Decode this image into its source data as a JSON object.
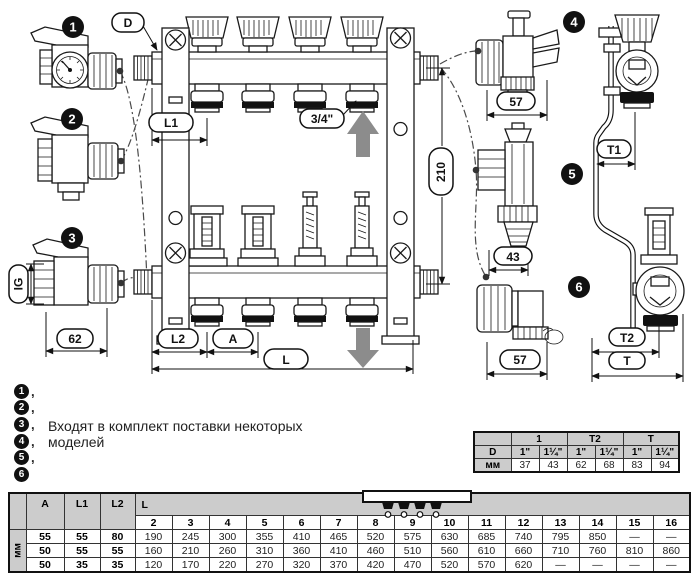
{
  "drawing": {
    "callout_numbers": {
      "n1": "1",
      "n2": "2",
      "n3": "3",
      "n4": "4",
      "n5": "5",
      "n6": "6"
    },
    "labels": {
      "d": "D",
      "l1": "L1",
      "three_quarter": "3/4\"",
      "h210": "210",
      "l2": "L2",
      "a": "A",
      "l": "L",
      "w57_top": "57",
      "w43": "43",
      "w57_bottom": "57",
      "t1": "T1",
      "t2": "T2",
      "t": "T",
      "ig": "IG",
      "w62": "62"
    }
  },
  "legend": {
    "items": [
      {
        "num": "1",
        "suffix": ","
      },
      {
        "num": "2",
        "suffix": ","
      },
      {
        "num": "3",
        "suffix": ","
      },
      {
        "num": "4",
        "suffix": ","
      },
      {
        "num": "5",
        "suffix": ","
      },
      {
        "num": "6",
        "suffix": ""
      }
    ],
    "line1": "Входят в комплект поставки некоторых",
    "line2": "моделей"
  },
  "right_table": {
    "group_headers": [
      "1",
      "T2",
      "T"
    ],
    "d_row": {
      "label": "D",
      "values": [
        "1\"",
        "1¼\"",
        "1\"",
        "1¼\"",
        "1\"",
        "1¼\""
      ]
    },
    "mm_row": {
      "label": "мм",
      "values": [
        "37",
        "43",
        "62",
        "68",
        "83",
        "94"
      ]
    }
  },
  "bottom_table": {
    "unit_label": "мм",
    "headers": {
      "a": "A",
      "l1": "L1",
      "l2": "L2",
      "l": "L"
    },
    "outlet_counts": [
      "2",
      "3",
      "4",
      "5",
      "6",
      "7",
      "8",
      "9",
      "10",
      "11",
      "12",
      "13",
      "14",
      "15",
      "16"
    ],
    "rows": [
      {
        "a": "55",
        "l1": "55",
        "l2": "80",
        "l_values": [
          "190",
          "245",
          "300",
          "355",
          "410",
          "465",
          "520",
          "575",
          "630",
          "685",
          "740",
          "795",
          "850",
          "—",
          "—"
        ]
      },
      {
        "a": "50",
        "l1": "55",
        "l2": "55",
        "l_values": [
          "160",
          "210",
          "260",
          "310",
          "360",
          "410",
          "460",
          "510",
          "560",
          "610",
          "660",
          "710",
          "760",
          "810",
          "860"
        ]
      },
      {
        "a": "50",
        "l1": "35",
        "l2": "35",
        "l_values": [
          "120",
          "170",
          "220",
          "270",
          "320",
          "370",
          "420",
          "470",
          "520",
          "570",
          "620",
          "—",
          "—",
          "—",
          "—"
        ]
      }
    ]
  }
}
